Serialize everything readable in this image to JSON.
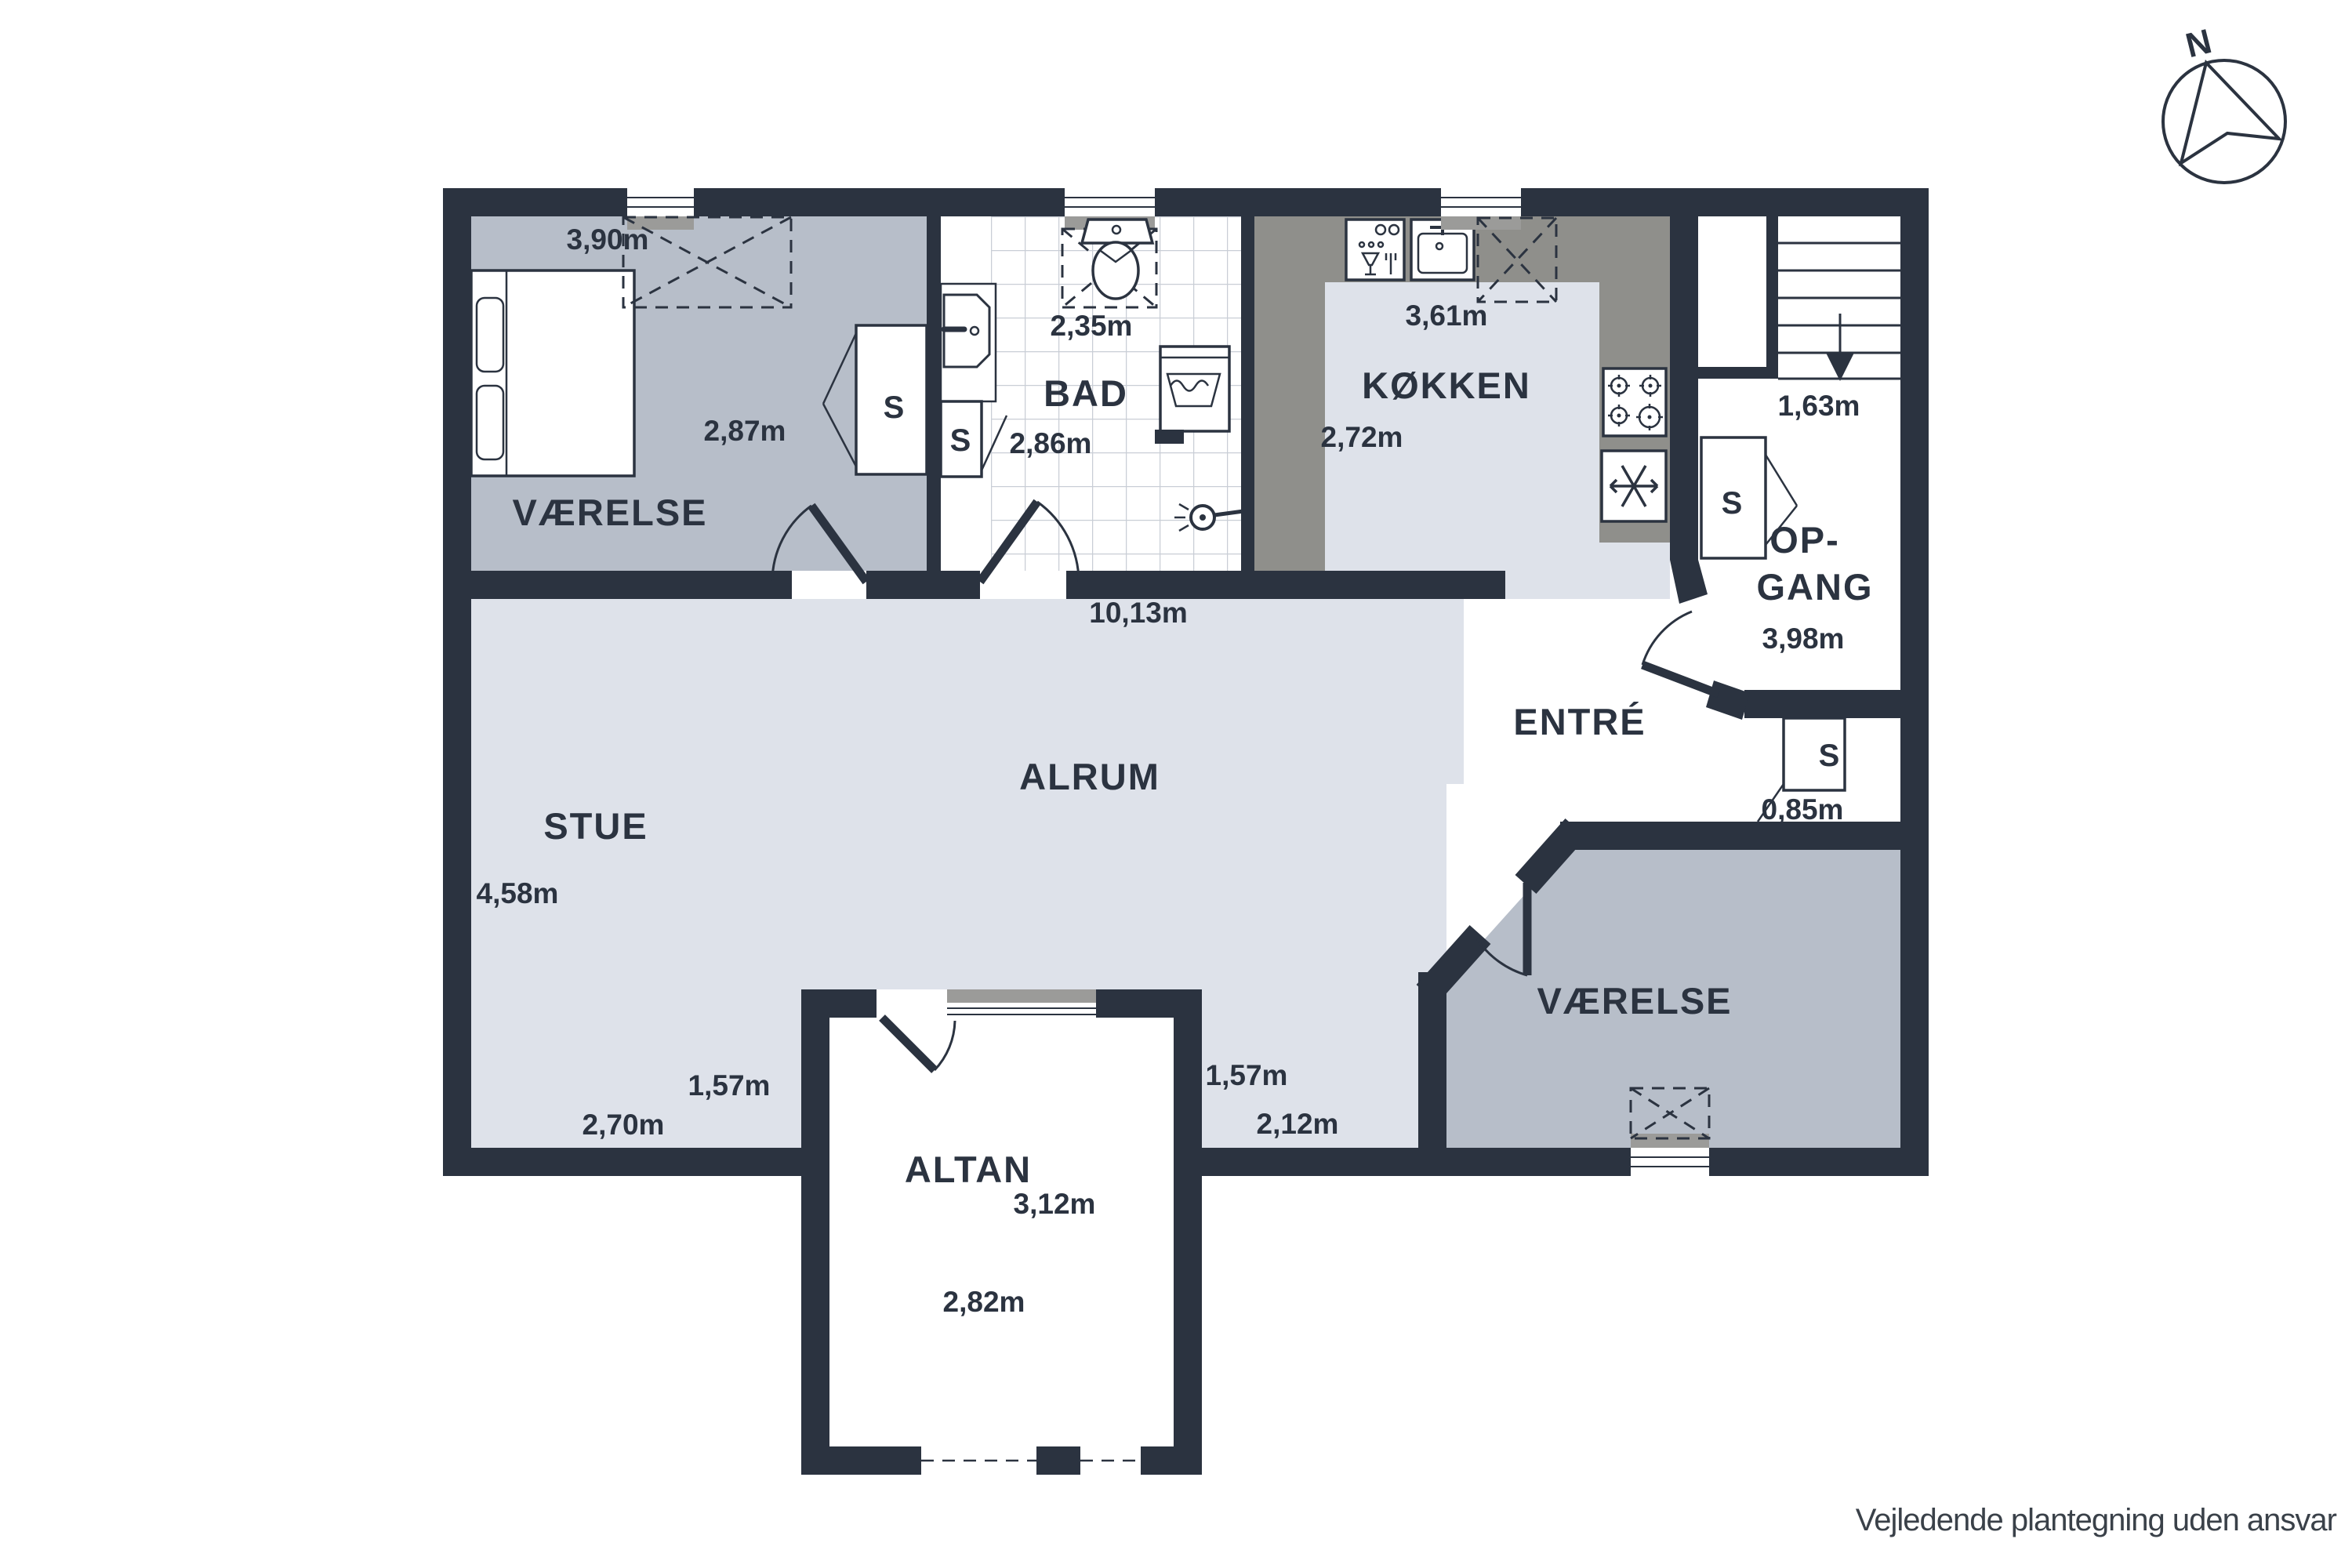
{
  "colors": {
    "wall": "#2b3340",
    "room_gray": "#b7bec9",
    "room_light": "#dee2ea",
    "counter_gray": "#8f8f8b",
    "sill_gray": "#9b9b99",
    "tile_line": "#c9ced6",
    "text": "#2b3340",
    "disclaimer_text": "#3a4149"
  },
  "compass": {
    "label": "N"
  },
  "footer": {
    "disclaimer": "Vejledende plantegning uden ansvar"
  },
  "closets": {
    "label": "S"
  },
  "rooms": {
    "vaerelse_nw": {
      "name": "VÆRELSE",
      "width": "3,90m",
      "depth": "2,87m"
    },
    "bad": {
      "name": "BAD",
      "width": "2,35m",
      "depth": "2,86m"
    },
    "koekken": {
      "name": "KØKKEN",
      "width": "3,61m",
      "depth": "2,72m"
    },
    "alrum": {
      "name": "ALRUM",
      "width": "10,13m",
      "opening": "1,57m",
      "bottom_width": "2,12m"
    },
    "stue": {
      "name": "STUE",
      "depth": "4,58m",
      "opening": "1,57m",
      "bottom_width": "2,70m"
    },
    "opgang": {
      "name_line1": "OP-",
      "name_line2": "GANG",
      "stair_width": "1,63m",
      "depth": "3,98m"
    },
    "entre": {
      "name": "ENTRÉ",
      "closet_width": "0,85m"
    },
    "vaerelse_se": {
      "name": "VÆRELSE"
    },
    "altan": {
      "name": "ALTAN",
      "depth": "3,12m",
      "width": "2,82m"
    }
  }
}
